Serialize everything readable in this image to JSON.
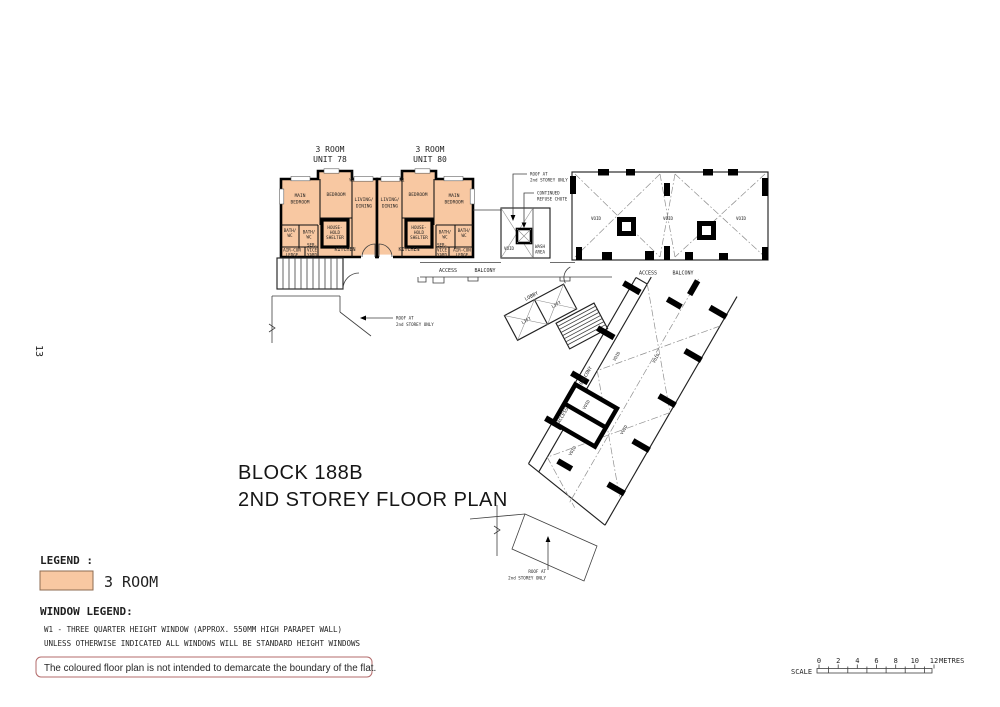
{
  "page_number": "13",
  "title": {
    "line1": "BLOCK 188B",
    "line2": "2ND STOREY FLOOR PLAN"
  },
  "units": [
    {
      "title_line1": "3 ROOM",
      "title_line2": "UNIT 78"
    },
    {
      "title_line1": "3 ROOM",
      "title_line2": "UNIT 80"
    }
  ],
  "room_labels": {
    "main_bedroom": [
      "MAIN",
      "BEDROOM"
    ],
    "bedroom": "BEDROOM",
    "living_dining": [
      "LIVING/",
      "DINING"
    ],
    "kitchen": "KITCHEN",
    "bath_wc": [
      "BATH/",
      "WC"
    ],
    "household_shelter": [
      "HOUSE-",
      "HOLD",
      "SHELTER"
    ],
    "service_yard": [
      "SER-",
      "VICE",
      "YARD"
    ],
    "aircon_ledge": [
      "AIR-CON",
      "LEDGE"
    ],
    "window_mark": "W1"
  },
  "plan_labels": {
    "void": "VOID",
    "wash_area": [
      "WASH",
      "AREA"
    ],
    "access": "ACCESS",
    "balcony": "BALCONY",
    "lobby": "LOBBY",
    "lift": "LIFT",
    "roof_note": [
      "ROOF AT",
      "2nd STOREY ONLY"
    ],
    "refuse_note": [
      "CONTINUED",
      "REFUSE CHUTE"
    ]
  },
  "legend": {
    "heading": "LEGEND :",
    "item_label": "3 ROOM",
    "swatch_color": "#F8C8A2"
  },
  "window_legend": {
    "heading": "WINDOW LEGEND:",
    "line1": "W1 - THREE QUARTER HEIGHT WINDOW (APPROX. 550MM HIGH PARAPET WALL)",
    "line2": "UNLESS OTHERWISE INDICATED ALL WINDOWS WILL BE STANDARD HEIGHT WINDOWS"
  },
  "note": "The coloured floor plan is not intended to demarcate the boundary of the flat.",
  "scale_bar": {
    "label": "SCALE",
    "ticks": [
      "0",
      "2",
      "4",
      "6",
      "8",
      "10",
      "12"
    ],
    "unit": "METRES"
  }
}
